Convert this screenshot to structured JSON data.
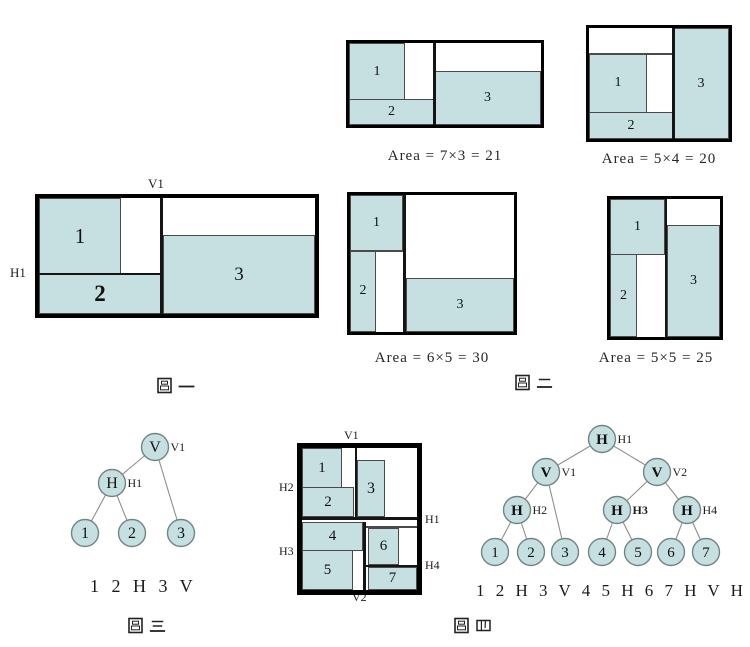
{
  "palette": {
    "block_fill": "#c6e0e1",
    "figure_border": "#000000",
    "divider_line": "#151515",
    "thin_line": "#4a4a4a",
    "node_fill": "#c6e0e1",
    "node_stroke": "#728585",
    "edge_color": "#8f8f8f",
    "text_color": "#1c1c1c"
  },
  "figure1": {
    "caption": "圖一",
    "cut_labels": {
      "v1": "V1",
      "h1": "H1"
    },
    "blocks": [
      "1",
      "2",
      "3"
    ]
  },
  "figure2": {
    "caption": "圖二",
    "candidates": [
      {
        "blocks": [
          "1",
          "2",
          "3"
        ],
        "area_label": "Area = 7×3 = 21"
      },
      {
        "blocks": [
          "1",
          "2",
          "3"
        ],
        "area_label": "Area = 5×4 = 20"
      },
      {
        "blocks": [
          "1",
          "2",
          "3"
        ],
        "area_label": "Area = 6×5 = 30"
      },
      {
        "blocks": [
          "1",
          "2",
          "3"
        ],
        "area_label": "Area = 5×5 = 25"
      }
    ]
  },
  "figure3": {
    "caption": "圖三",
    "polish_expression": "1 2 H 3 V",
    "tree": {
      "nodes": [
        {
          "label": "V",
          "tag": "V1"
        },
        {
          "label": "H",
          "tag": "H1"
        },
        {
          "label": "1",
          "tag": ""
        },
        {
          "label": "2",
          "tag": ""
        },
        {
          "label": "3",
          "tag": ""
        }
      ]
    }
  },
  "figure4": {
    "caption": "圖四",
    "polish_expression": "1 2 H 3 V 4 5 H 6 7 H V H",
    "floorplan": {
      "blocks": [
        "1",
        "2",
        "3",
        "4",
        "5",
        "6",
        "7"
      ],
      "cut_labels": {
        "v1": "V1",
        "h2": "H2",
        "h3": "H3",
        "h1": "H1",
        "h4": "H4",
        "v2": "V2"
      }
    },
    "tree": {
      "nodes": [
        {
          "label": "H",
          "tag": "H1"
        },
        {
          "label": "V",
          "tag": "V1"
        },
        {
          "label": "V",
          "tag": "V2"
        },
        {
          "label": "H",
          "tag": "H2"
        },
        {
          "label": "H",
          "tag": "H3"
        },
        {
          "label": "H",
          "tag": "H4"
        },
        {
          "label": "1",
          "tag": ""
        },
        {
          "label": "2",
          "tag": ""
        },
        {
          "label": "3",
          "tag": ""
        },
        {
          "label": "4",
          "tag": ""
        },
        {
          "label": "5",
          "tag": ""
        },
        {
          "label": "6",
          "tag": ""
        },
        {
          "label": "7",
          "tag": ""
        }
      ]
    }
  }
}
